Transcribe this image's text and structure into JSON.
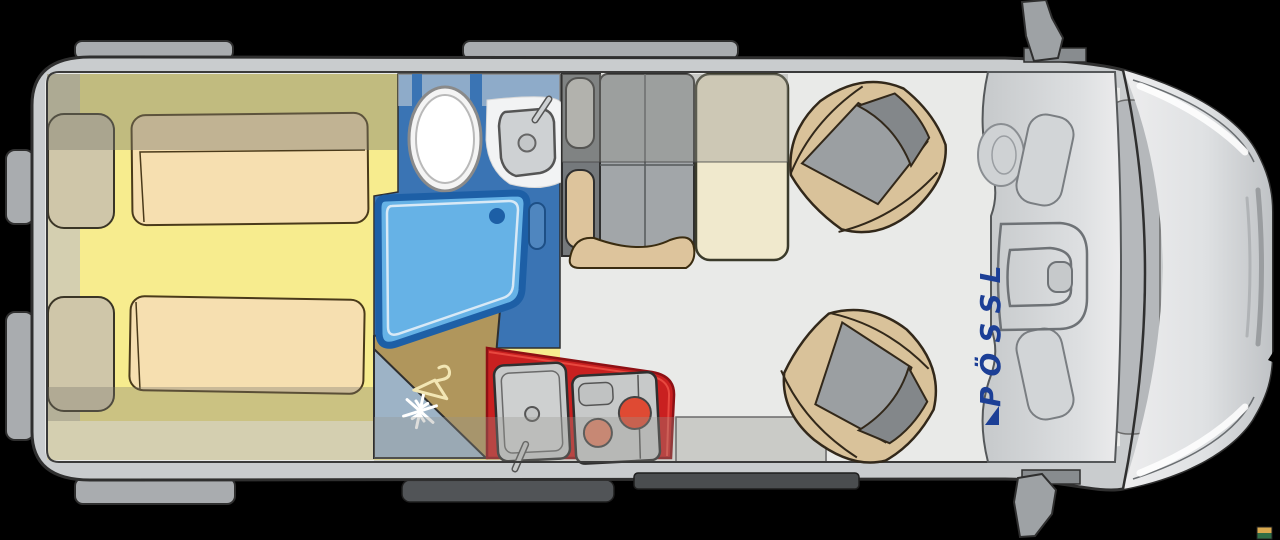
{
  "brand": {
    "label": "PÖSSL"
  },
  "icons": {
    "fridge": "snowflake-icon",
    "wardrobe": "hanger-icon",
    "watermark": "photo-watermark-flag"
  },
  "colors": {
    "background": "#000000",
    "body": "#c9ccce",
    "body_outline": "#2f2f2f",
    "tab_gray": "#a9acaf",
    "floor": "#e9eae8",
    "cabinet_beige": "#d4cfb0",
    "bed_yellow": "#f7ec8e",
    "mattress_cream": "#f6dfb0",
    "pillow_beige": "#cfc6a9",
    "bathroom_blue": "#3a74b4",
    "shower_blue": "#66b2e6",
    "shower_border": "#1d5fa6",
    "fridge_blue_gray": "#9db3c6",
    "wardrobe_tan": "#b0965c",
    "hanger_cream": "#f2e6b4",
    "kitchen_red": "#c92020",
    "appliance_gray": "#c7c9c9",
    "burner_orange": "#df4a33",
    "burner_salmon": "#df8268",
    "bench_gray": "#a2a6a9",
    "backrest_gray": "#75797c",
    "headrest_light": "#c6c6c1",
    "fabric_beige": "#ddc49c",
    "table_ivory": "#f0e9cd",
    "seat_beige": "#d9c29a",
    "seat_gray": "#9b9fa2",
    "seat_gray_dark": "#83878a",
    "windshield_band": "#b5b8bb",
    "step_dark": "#4a4d4f",
    "brand_navy": "#1c3f96",
    "watermark_gold": "#d9a94f",
    "watermark_green": "#2f6e46"
  }
}
